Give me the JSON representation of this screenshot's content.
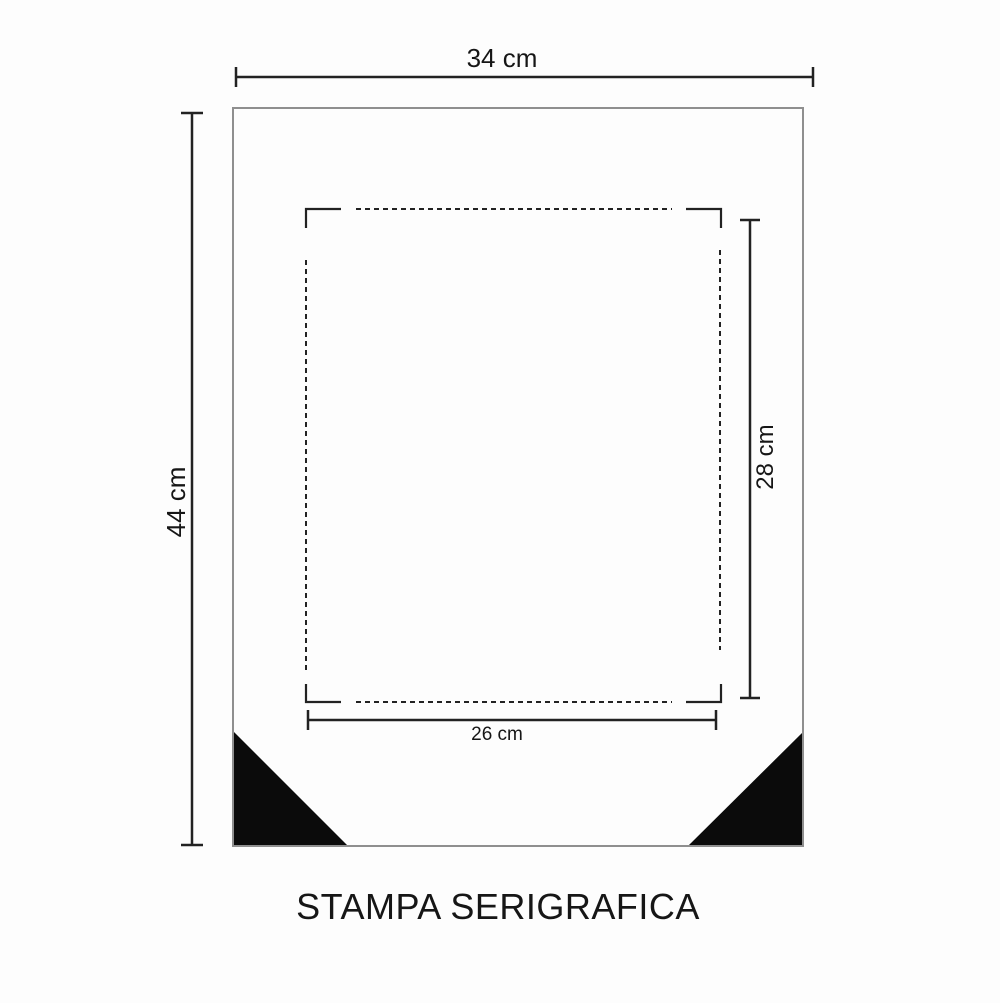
{
  "page": {
    "title": "STAMPA SERIGRAFICA"
  },
  "sheet": {
    "width_label": "34 cm",
    "height_label": "44 cm",
    "width_cm": 34,
    "height_cm": 44
  },
  "print_area": {
    "width_label": "26 cm",
    "height_label": "28 cm",
    "width_cm": 26,
    "height_cm": 28
  },
  "colors": {
    "background": "#fdfdfd",
    "line": "#222222",
    "sheet-border": "#8f8f8f",
    "triangle": "#0b0b0b",
    "text": "#161616"
  }
}
